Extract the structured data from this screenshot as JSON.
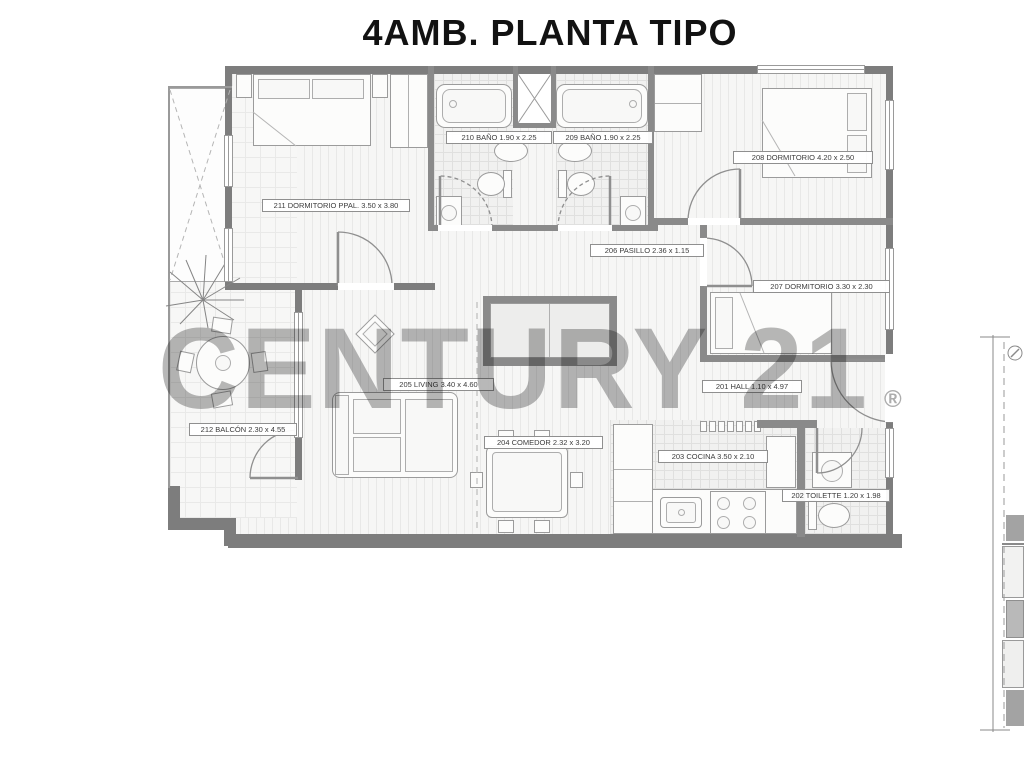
{
  "title": "4AMB. PLANTA TIPO",
  "watermark": {
    "text": "CENTURY 21",
    "registered": "®",
    "color": "#8c8c8c"
  },
  "plan": {
    "rooms": [
      {
        "number": "211",
        "name": "DORMITORIO PPAL.",
        "dims": "3.50 x 3.80",
        "label": "211 DORMITORIO PPAL. 3.50 x 3.80"
      },
      {
        "number": "210",
        "name": "BAÑO",
        "dims": "1.90 x 2.25",
        "label": "210 BAÑO 1.90 x 2.25"
      },
      {
        "number": "209",
        "name": "BAÑO",
        "dims": "1.90 x 2.25",
        "label": "209 BAÑO 1.90 x 2.25"
      },
      {
        "number": "208",
        "name": "DORMITORIO",
        "dims": "4.20 x 2.50",
        "label": "208 DORMITORIO 4.20 x 2.50"
      },
      {
        "number": "206",
        "name": "PASILLO",
        "dims": "2.36 x 1.15",
        "label": "206 PASILLO 2.36 x 1.15"
      },
      {
        "number": "207",
        "name": "DORMITORIO",
        "dims": "3.30 x 2.30",
        "label": "207 DORMITORIO 3.30 x 2.30"
      },
      {
        "number": "201",
        "name": "HALL",
        "dims": "1.10 x 4.97",
        "label": "201 HALL 1.10 x 4.97"
      },
      {
        "number": "205",
        "name": "LIVING",
        "dims": "3.40 x 4.60",
        "label": "205 LIVING 3.40 x 4.60"
      },
      {
        "number": "204",
        "name": "COMEDOR",
        "dims": "2.32 x 3.20",
        "label": "204 COMEDOR 2.32 x 3.20"
      },
      {
        "number": "203",
        "name": "COCINA",
        "dims": "3.50 x 2.10",
        "label": "203 COCINA 3.50 x 2.10"
      },
      {
        "number": "202",
        "name": "TOILETTE",
        "dims": "1.20 x 1.98",
        "label": "202 TOILETTE 1.20 x 1.98"
      },
      {
        "number": "212",
        "name": "BALCÓN",
        "dims": "2.30 x 4.55",
        "label": "212 BALCÓN 2.30 x 4.55"
      }
    ]
  },
  "colors": {
    "wall": "#7d7d7d",
    "interior_wall": "#8a8a8a",
    "watermark": "#8c8c8c",
    "background": "#ffffff"
  }
}
